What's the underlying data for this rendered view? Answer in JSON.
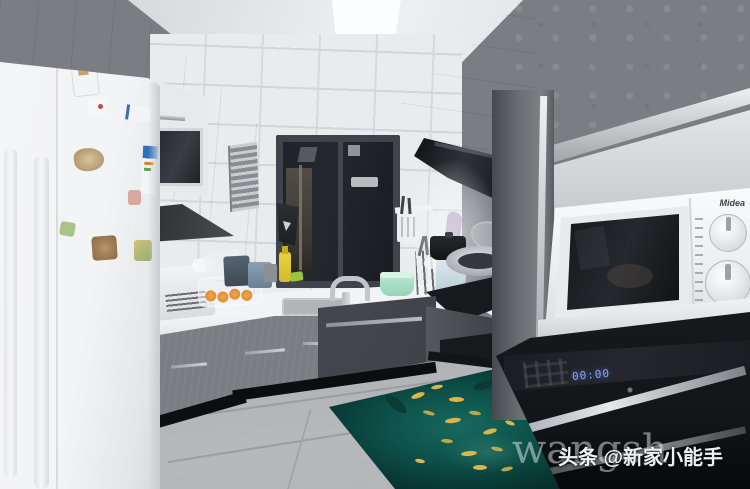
{
  "watermarks": {
    "faint_text": "wangsh",
    "channel_text": "头条 @新家小能手"
  },
  "microwave": {
    "brand": "Midea"
  },
  "oven": {
    "display": "00:00"
  },
  "colors": {
    "cabinet_gray": "#8b8e93",
    "cabinet_dark": "#3f4247",
    "countertop_white": "#f2f3f5",
    "tile_white": "#e9eced",
    "fridge_white": "#f4f5f6",
    "floor_gray": "#b6b8bb",
    "mat_teal": "#0d5049",
    "fish_gold": "#d9b54a",
    "appliance_black": "#131519",
    "led_blue": "#8ca0f0",
    "window_dark": "#24272c"
  }
}
